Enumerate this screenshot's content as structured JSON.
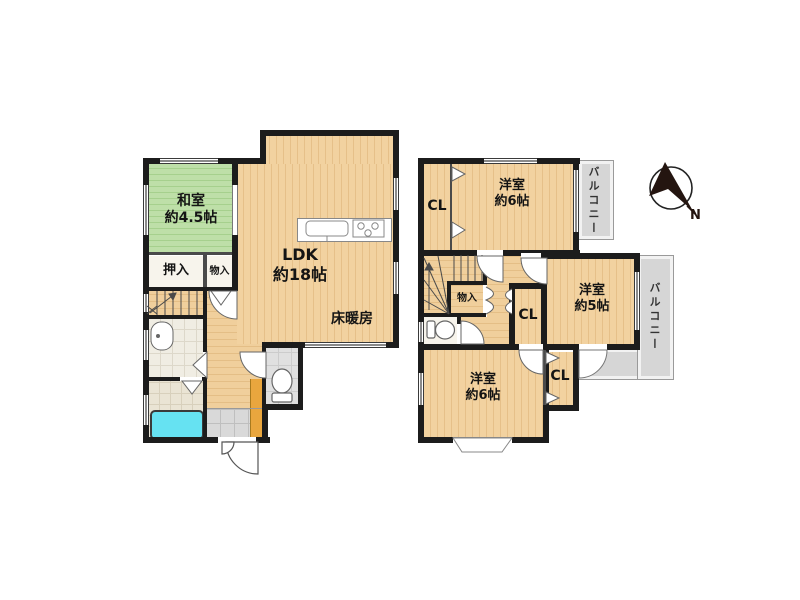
{
  "floor1": {
    "washitsu": {
      "name": "和室",
      "size": "約4.5帖"
    },
    "ldk": {
      "name": "LDK",
      "size": "約18帖"
    },
    "floor_heating": "床暖房",
    "oshiire": "押入",
    "monoire": "物入"
  },
  "floor2": {
    "yoshitsu_top": {
      "name": "洋室",
      "size": "約6帖"
    },
    "yoshitsu_mid": {
      "name": "洋室",
      "size": "約5帖"
    },
    "yoshitsu_bottom": {
      "name": "洋室",
      "size": "約6帖"
    },
    "closet_top": "CL",
    "closet_mid": "CL",
    "closet_bottom": "CL",
    "monoire": "物入",
    "balcony_top": "バルコニー",
    "balcony_right": "バルコニー"
  },
  "compass": {
    "north_label": "N"
  },
  "colors": {
    "wall": "#1c1c1c",
    "wood_floor": "#f2d2a0",
    "tatami_green": "#b9dda4",
    "bathtub_cyan": "#66e2f2",
    "shoe_cabinet_orange": "#e9a63e",
    "balcony_gray": "#d6d6d6"
  }
}
